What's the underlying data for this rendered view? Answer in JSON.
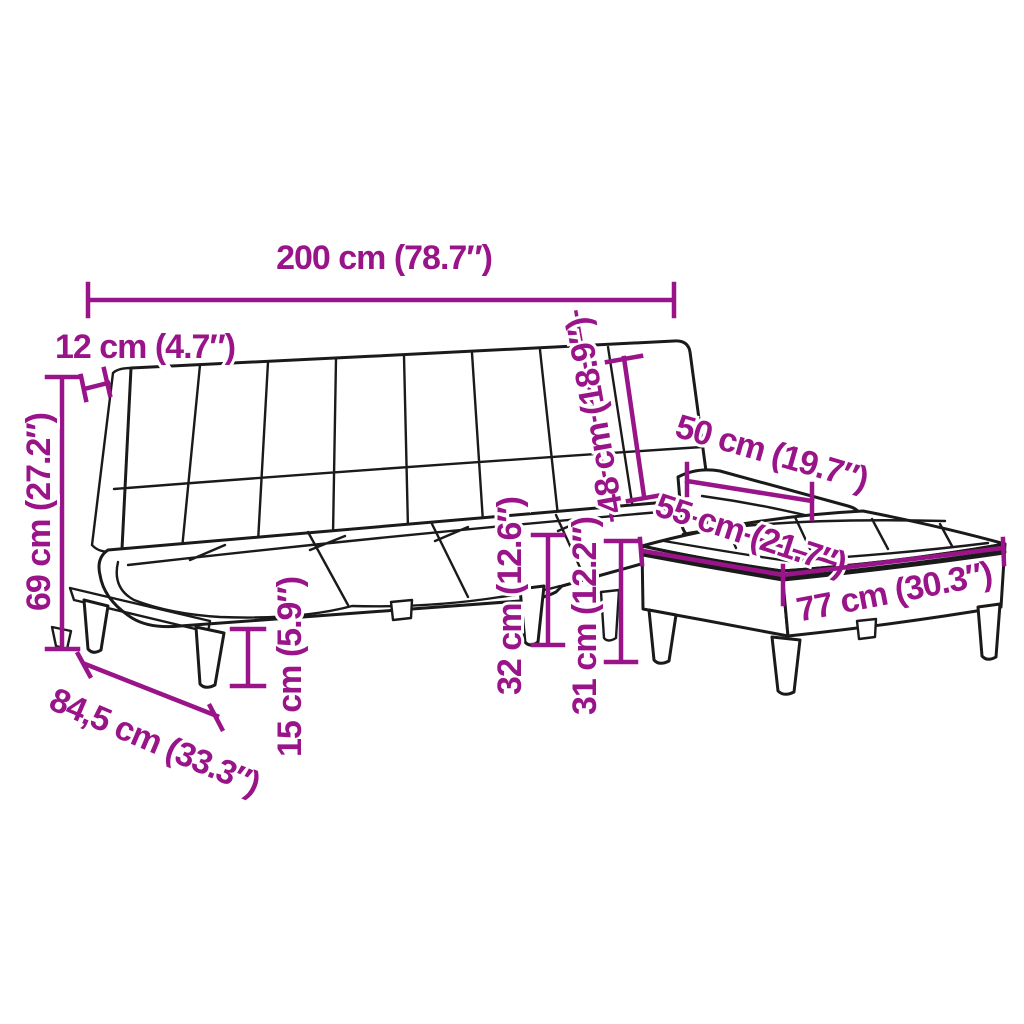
{
  "diagram": {
    "type": "furniture-dimension-diagram",
    "subject": "sofa-bed-with-footstool-line-art",
    "colors": {
      "dimension": "#9A1489",
      "outline": "#1A1A1A",
      "background": "#FFFFFF"
    },
    "dimensions": [
      {
        "id": "total-width",
        "value_cm": "200",
        "value_inch": "78.7",
        "label": "200 cm (78.7″)"
      },
      {
        "id": "backrest-thickness",
        "value_cm": "12",
        "value_inch": "4.7",
        "label": "12 cm (4.7″)"
      },
      {
        "id": "overall-height",
        "value_cm": "69",
        "value_inch": "27.2",
        "label": "69 cm (27.2″)"
      },
      {
        "id": "backrest-height",
        "value_cm": "48",
        "value_inch": "18.9",
        "label": "48 cm (18.9″)"
      },
      {
        "id": "right-seat-depth",
        "value_cm": "50",
        "value_inch": "19.7",
        "label": "50 cm (19.7″)"
      },
      {
        "id": "footstool-depth",
        "value_cm": "55",
        "value_inch": "21.7",
        "label": "55 cm (21.7″)"
      },
      {
        "id": "footstool-width",
        "value_cm": "77",
        "value_inch": "30.3",
        "label": "77 cm (30.3″)"
      },
      {
        "id": "seat-height",
        "value_cm": "32",
        "value_inch": "12.6",
        "label": "32 cm (12.6″)"
      },
      {
        "id": "footstool-height",
        "value_cm": "31",
        "value_inch": "12.2",
        "label": "31 cm (12.2″)"
      },
      {
        "id": "leg-height",
        "value_cm": "15",
        "value_inch": "5.9",
        "label": "15 cm (5.9″)"
      },
      {
        "id": "seat-depth",
        "value_cm": "84,5",
        "value_inch": "33.3",
        "label": "84,5 cm (33.3″)"
      }
    ]
  }
}
